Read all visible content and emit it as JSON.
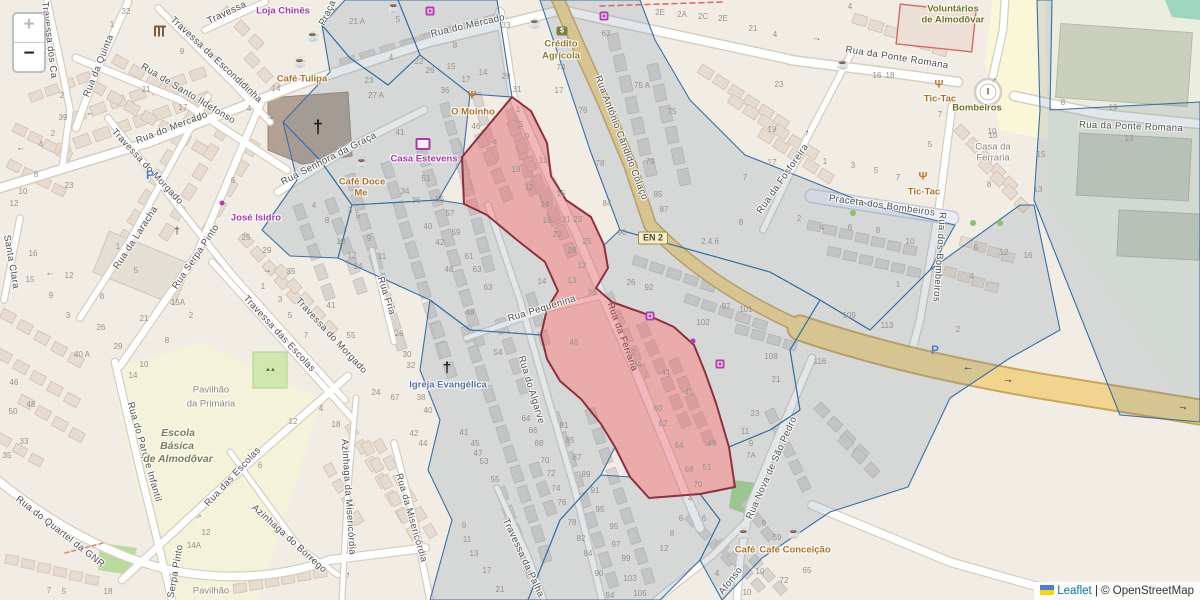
{
  "map": {
    "controls": {
      "zoom_in": "+",
      "zoom_out": "−"
    },
    "attribution": {
      "leaflet": "Leaflet",
      "separator": "|",
      "osm": "© OpenStreetMap"
    },
    "colors": {
      "background": "#f1ede5",
      "overlay_blue_stroke": "#3a70a3",
      "overlay_blue_fill": "rgba(110,134,158,0.20)",
      "overlay_red_fill": "rgba(222,84,90,0.42)",
      "overlay_red_stroke": "#8f3040",
      "highway_yellow": "#f1d48e"
    }
  },
  "badges": [
    [
      "EN 2",
      653,
      238
    ]
  ],
  "street_labels": [
    [
      "Rua do Mercado",
      172,
      128,
      -21
    ],
    [
      "Rua do Mercado",
      468,
      26,
      -13
    ],
    [
      "Travessa",
      227,
      13,
      -25
    ],
    [
      "Travessa dos Ca",
      49,
      40,
      83
    ],
    [
      "Travessa da Escondidinha",
      216,
      60,
      43
    ],
    [
      "Rua de Santo Ildefonso",
      188,
      94,
      31
    ],
    [
      "Rua da Quinta",
      99,
      66,
      -68
    ],
    [
      "Santa Clara",
      11,
      262,
      80
    ],
    [
      "Rua da Laracha",
      136,
      238,
      -57
    ],
    [
      "Rua Serpa Pinto",
      196,
      257,
      -56
    ],
    [
      "Rua Serpa Pinto",
      174,
      582,
      -80
    ],
    [
      "Travessa do Morgado",
      147,
      167,
      47
    ],
    [
      "Travessa do Morgado",
      331,
      336,
      47
    ],
    [
      "Travessa das Escolas",
      279,
      334,
      47
    ],
    [
      "Rua Fria",
      386,
      296,
      72
    ],
    [
      "Rua Senhora da Graça",
      329,
      159,
      -27
    ],
    [
      "Rua da Ponte Romana",
      897,
      58,
      9
    ],
    [
      "Rua da Ponte Romana",
      1131,
      127,
      2
    ],
    [
      "Rua da Fosforeira",
      783,
      179,
      -55
    ],
    [
      "Praceta dos Bombeiros",
      882,
      206,
      8
    ],
    [
      "Rua dos Bombeiros",
      939,
      257,
      94
    ],
    [
      "Rua António Cândido Colaço",
      621,
      138,
      69
    ],
    [
      "Rua da Ferraria",
      622,
      337,
      70,
      "on-red"
    ],
    [
      "Rua Pequenina",
      542,
      309,
      -17
    ],
    [
      "Rua do Algarve",
      531,
      390,
      73
    ],
    [
      "Rua da Misericórdia",
      411,
      518,
      74
    ],
    [
      "Travessa da Palha",
      523,
      558,
      65
    ],
    [
      "Rua das Escolas",
      233,
      477,
      -47
    ],
    [
      "Rua do Parque Infantil",
      144,
      452,
      74
    ],
    [
      "Rua do Quartel da GNR",
      60,
      532,
      38
    ],
    [
      "Azinhaga do Borrego",
      289,
      539,
      42
    ],
    [
      "Azinhaga da Misericórdia",
      348,
      497,
      86
    ],
    [
      "Rua Nova de São Pedro",
      772,
      468,
      -66
    ],
    [
      "Afonso",
      731,
      581,
      -52
    ],
    [
      "Praça",
      328,
      13,
      -64
    ]
  ],
  "poi_labels": [
    [
      "Loja Chinês",
      283,
      11,
      "shop"
    ],
    [
      "Café Tulipa",
      302,
      79,
      "food"
    ],
    [
      "Café Doce",
      362,
      182,
      "food"
    ],
    [
      "Me",
      361,
      193,
      "food"
    ],
    [
      "José Isidro",
      256,
      218,
      "shop"
    ],
    [
      "Casa Estevens",
      424,
      159,
      "shop"
    ],
    [
      "O Moinho",
      473,
      112,
      "food"
    ],
    [
      "Crédito",
      561,
      44,
      "bank"
    ],
    [
      "Agrícola",
      561,
      56,
      "bank"
    ],
    [
      "Voluntários",
      953,
      9,
      "civic"
    ],
    [
      "de Almodôvar",
      953,
      20,
      "civic"
    ],
    [
      "Bombeiros",
      977,
      108,
      "civic"
    ],
    [
      "Tic-Tac",
      940,
      99,
      "food"
    ],
    [
      "Tic-Tac",
      924,
      192,
      "food"
    ],
    [
      "Casa da",
      993,
      147,
      "grey"
    ],
    [
      "Ferraria",
      993,
      158,
      "grey"
    ],
    [
      "Igreja Evangélica",
      448,
      385,
      "church"
    ],
    [
      "Escola",
      178,
      433,
      "school"
    ],
    [
      "Básica",
      177,
      446,
      "school"
    ],
    [
      "de Almodôvar",
      178,
      459,
      "school"
    ],
    [
      "Pavilhão",
      211,
      390,
      "grey"
    ],
    [
      "da Primária",
      211,
      404,
      "grey"
    ],
    [
      "Pavilhão",
      211,
      591,
      "grey"
    ],
    [
      "Café",
      745,
      550,
      "food"
    ],
    [
      "Café Conceição",
      795,
      550,
      "food"
    ]
  ],
  "house_numbers": [
    [
      "32",
      126,
      12
    ],
    [
      "1",
      112,
      25
    ],
    [
      "9",
      182,
      52
    ],
    [
      "21",
      146,
      90
    ],
    [
      "17",
      183,
      108
    ],
    [
      "15",
      197,
      119
    ],
    [
      "4",
      249,
      109
    ],
    [
      "14",
      276,
      89
    ],
    [
      "2",
      62,
      96
    ],
    [
      "39",
      63,
      118
    ],
    [
      "2",
      53,
      134
    ],
    [
      "4",
      41,
      145
    ],
    [
      "8",
      36,
      175
    ],
    [
      "10",
      23,
      192
    ],
    [
      "23",
      69,
      186
    ],
    [
      "6",
      233,
      181
    ],
    [
      "12",
      14,
      204
    ],
    [
      "16",
      33,
      254
    ],
    [
      "15",
      30,
      280
    ],
    [
      "12",
      69,
      276
    ],
    [
      "9",
      51,
      296
    ],
    [
      "8",
      102,
      297
    ],
    [
      "3",
      68,
      316
    ],
    [
      "26",
      101,
      328
    ],
    [
      "5",
      136,
      271
    ],
    [
      "1",
      118,
      247
    ],
    [
      "29",
      118,
      347
    ],
    [
      "40 A",
      82,
      355
    ],
    [
      "46",
      14,
      383
    ],
    [
      "10",
      144,
      365
    ],
    [
      "14",
      133,
      376
    ],
    [
      "21",
      144,
      319
    ],
    [
      "15A",
      178,
      303
    ],
    [
      "2",
      191,
      316
    ],
    [
      "8",
      167,
      341
    ],
    [
      "25",
      246,
      238
    ],
    [
      "29",
      267,
      251
    ],
    [
      "35",
      291,
      272
    ],
    [
      "1",
      263,
      287
    ],
    [
      "3",
      280,
      300
    ],
    [
      "5",
      290,
      316
    ],
    [
      "7",
      306,
      336
    ],
    [
      "41",
      331,
      306
    ],
    [
      "55",
      351,
      336
    ],
    [
      "4",
      314,
      206
    ],
    [
      "3",
      350,
      211
    ],
    [
      "5",
      358,
      216
    ],
    [
      "8",
      327,
      221
    ],
    [
      "10",
      341,
      242
    ],
    [
      "9",
      369,
      239
    ],
    [
      "11",
      382,
      257
    ],
    [
      "14",
      358,
      267
    ],
    [
      "12",
      352,
      256
    ],
    [
      "24",
      376,
      393
    ],
    [
      "21 A",
      357,
      22
    ],
    [
      "5",
      398,
      20
    ],
    [
      "4",
      391,
      58
    ],
    [
      "8",
      455,
      46
    ],
    [
      "22",
      419,
      62
    ],
    [
      "26",
      430,
      71
    ],
    [
      "15",
      451,
      67
    ],
    [
      "23",
      369,
      81
    ],
    [
      "27 A",
      376,
      96
    ],
    [
      "36",
      445,
      91
    ],
    [
      "17",
      466,
      80
    ],
    [
      "14",
      483,
      73
    ],
    [
      "29",
      506,
      77
    ],
    [
      "31",
      517,
      90
    ],
    [
      "33",
      506,
      26
    ],
    [
      "17",
      559,
      91
    ],
    [
      "74",
      561,
      68
    ],
    [
      "46",
      476,
      127
    ],
    [
      "51",
      426,
      179
    ],
    [
      "41",
      400,
      133
    ],
    [
      "34",
      405,
      192
    ],
    [
      "36",
      416,
      201
    ],
    [
      "55",
      440,
      200
    ],
    [
      "57",
      450,
      214
    ],
    [
      "40",
      428,
      227
    ],
    [
      "59",
      456,
      233
    ],
    [
      "42",
      440,
      243
    ],
    [
      "61",
      469,
      257
    ],
    [
      "46",
      449,
      270
    ],
    [
      "63",
      477,
      270
    ],
    [
      "63",
      488,
      288
    ],
    [
      "48",
      470,
      313
    ],
    [
      "54",
      498,
      353
    ],
    [
      "1",
      518,
      110
    ],
    [
      "5",
      521,
      125
    ],
    [
      "9",
      527,
      137
    ],
    [
      "4",
      495,
      143
    ],
    [
      "19",
      516,
      170
    ],
    [
      "11",
      543,
      161
    ],
    [
      "12",
      529,
      188
    ],
    [
      "15",
      561,
      194
    ],
    [
      "14",
      545,
      205
    ],
    [
      "16",
      547,
      221
    ],
    [
      "21-23",
      572,
      220
    ],
    [
      "22",
      557,
      235
    ],
    [
      "25",
      587,
      242
    ],
    [
      "28",
      572,
      251
    ],
    [
      "12",
      582,
      266
    ],
    [
      "13",
      572,
      281
    ],
    [
      "36",
      592,
      293
    ],
    [
      "14",
      542,
      282
    ],
    [
      "63",
      606,
      34
    ],
    [
      "75 A",
      642,
      86
    ],
    [
      "75",
      672,
      112
    ],
    [
      "76",
      583,
      111
    ],
    [
      "78",
      600,
      164
    ],
    [
      "79",
      650,
      162
    ],
    [
      "85",
      658,
      195
    ],
    [
      "2E",
      660,
      13
    ],
    [
      "2A",
      682,
      15
    ],
    [
      "2C",
      703,
      17
    ],
    [
      "2E",
      723,
      19
    ],
    [
      "21",
      753,
      29
    ],
    [
      "4",
      775,
      35
    ],
    [
      "23",
      779,
      85
    ],
    [
      "19",
      772,
      130
    ],
    [
      "17",
      772,
      163
    ],
    [
      "7",
      745,
      178
    ],
    [
      "84",
      607,
      204
    ],
    [
      "87",
      664,
      210
    ],
    [
      "90",
      622,
      233
    ],
    [
      "2.4.6",
      710,
      242
    ],
    [
      "8",
      741,
      223
    ],
    [
      "26",
      631,
      283
    ],
    [
      "92",
      649,
      288
    ],
    [
      "97",
      726,
      307
    ],
    [
      "101",
      746,
      310
    ],
    [
      "102",
      703,
      323
    ],
    [
      "108",
      771,
      357
    ],
    [
      "21",
      776,
      380
    ],
    [
      "46",
      574,
      343
    ],
    [
      "52",
      631,
      353
    ],
    [
      "54",
      637,
      365
    ],
    [
      "41",
      666,
      373
    ],
    [
      "45",
      689,
      393
    ],
    [
      "4",
      850,
      7
    ],
    [
      "16",
      877,
      76
    ],
    [
      "18",
      890,
      76
    ],
    [
      "7",
      940,
      115
    ],
    [
      "10",
      992,
      132
    ],
    [
      "5",
      930,
      145
    ],
    [
      "1",
      825,
      162
    ],
    [
      "3",
      853,
      166
    ],
    [
      "5",
      876,
      171
    ],
    [
      "7",
      898,
      178
    ],
    [
      "8",
      989,
      185
    ],
    [
      "15",
      1041,
      155
    ],
    [
      "13",
      1038,
      190
    ],
    [
      "10",
      993,
      136
    ],
    [
      "2",
      799,
      219
    ],
    [
      "4",
      822,
      228
    ],
    [
      "6",
      850,
      228
    ],
    [
      "8",
      878,
      231
    ],
    [
      "10",
      910,
      242
    ],
    [
      "1",
      898,
      285
    ],
    [
      "109",
      849,
      316
    ],
    [
      "113",
      887,
      326
    ],
    [
      "116",
      820,
      362
    ],
    [
      "6",
      976,
      248
    ],
    [
      "12",
      1004,
      253
    ],
    [
      "16",
      1028,
      256
    ],
    [
      "4",
      972,
      277
    ],
    [
      "2",
      958,
      330
    ],
    [
      "8",
      1063,
      103
    ],
    [
      "19",
      1113,
      108
    ],
    [
      "13",
      1129,
      139
    ],
    [
      "50",
      13,
      412
    ],
    [
      "48",
      31,
      405
    ],
    [
      "33",
      24,
      442
    ],
    [
      "35",
      7,
      456
    ],
    [
      "12",
      293,
      422
    ],
    [
      "18",
      336,
      425
    ],
    [
      "4",
      321,
      409
    ],
    [
      "6",
      260,
      466
    ],
    [
      "12",
      206,
      533
    ],
    [
      "14A",
      194,
      546
    ],
    [
      "18",
      108,
      592
    ],
    [
      "7",
      49,
      591
    ],
    [
      "5",
      64,
      592
    ],
    [
      "40",
      428,
      411
    ],
    [
      "42",
      414,
      434
    ],
    [
      "44",
      423,
      444
    ],
    [
      "41",
      464,
      433
    ],
    [
      "45",
      475,
      444
    ],
    [
      "47",
      478,
      454
    ],
    [
      "53",
      484,
      462
    ],
    [
      "55",
      495,
      480
    ],
    [
      "64",
      526,
      419
    ],
    [
      "66",
      533,
      431
    ],
    [
      "68",
      539,
      444
    ],
    [
      "70",
      545,
      461
    ],
    [
      "72",
      551,
      474
    ],
    [
      "74",
      556,
      489
    ],
    [
      "76",
      562,
      503
    ],
    [
      "78",
      572,
      523
    ],
    [
      "81",
      564,
      426
    ],
    [
      "85",
      570,
      441
    ],
    [
      "87",
      577,
      458
    ],
    [
      "89",
      586,
      475
    ],
    [
      "91",
      595,
      491
    ],
    [
      "95",
      600,
      510
    ],
    [
      "95",
      614,
      527
    ],
    [
      "82",
      581,
      539
    ],
    [
      "84",
      588,
      554
    ],
    [
      "90",
      599,
      574
    ],
    [
      "94",
      610,
      596
    ],
    [
      "97",
      616,
      545
    ],
    [
      "99",
      626,
      559
    ],
    [
      "103",
      630,
      579
    ],
    [
      "105",
      640,
      594
    ],
    [
      "9",
      464,
      526
    ],
    [
      "11",
      467,
      540
    ],
    [
      "13",
      474,
      554
    ],
    [
      "17",
      487,
      571
    ],
    [
      "21",
      500,
      590
    ],
    [
      "26",
      399,
      334
    ],
    [
      "30",
      407,
      355
    ],
    [
      "32",
      411,
      366
    ],
    [
      "38",
      421,
      398
    ],
    [
      "67",
      395,
      398
    ],
    [
      "60",
      658,
      409
    ],
    [
      "62",
      663,
      424
    ],
    [
      "64",
      679,
      446
    ],
    [
      "49",
      712,
      444
    ],
    [
      "68",
      689,
      470
    ],
    [
      "51",
      707,
      468
    ],
    [
      "70",
      698,
      485
    ],
    [
      "4",
      690,
      499
    ],
    [
      "6",
      681,
      519
    ],
    [
      "6",
      704,
      519
    ],
    [
      "8",
      672,
      534
    ],
    [
      "12",
      664,
      549
    ],
    [
      "23",
      755,
      414
    ],
    [
      "11",
      745,
      432
    ],
    [
      "9",
      751,
      444
    ],
    [
      "7A",
      751,
      456
    ],
    [
      "9",
      764,
      524
    ],
    [
      "59",
      777,
      538
    ],
    [
      "10",
      760,
      572
    ],
    [
      "4",
      717,
      574
    ],
    [
      "10",
      747,
      593
    ],
    [
      "72",
      784,
      581
    ],
    [
      "65",
      807,
      571
    ]
  ],
  "icons": [
    {
      "n": "cafe-icon",
      "x": 394,
      "y": 8
    },
    {
      "n": "cafe-icon",
      "x": 535,
      "y": 24
    },
    {
      "n": "cafe-icon",
      "x": 313,
      "y": 37
    },
    {
      "n": "cafe-icon",
      "x": 300,
      "y": 63
    },
    {
      "n": "cafe-icon",
      "x": 362,
      "y": 163
    },
    {
      "n": "cafe-icon",
      "x": 843,
      "y": 65
    },
    {
      "n": "cafe-icon",
      "x": 744,
      "y": 534
    },
    {
      "n": "cafe-icon",
      "x": 794,
      "y": 534
    },
    {
      "n": "restaurant-icon",
      "x": 472,
      "y": 96
    },
    {
      "n": "restaurant-icon",
      "x": 939,
      "y": 85
    },
    {
      "n": "restaurant-icon",
      "x": 923,
      "y": 177
    },
    {
      "n": "bank-icon",
      "x": 562,
      "y": 31
    },
    {
      "n": "museum-icon",
      "x": 160,
      "y": 31
    },
    {
      "n": "tv-shop-icon",
      "x": 423,
      "y": 144
    },
    {
      "n": "shop-icon",
      "x": 430,
      "y": 11
    },
    {
      "n": "shop-icon",
      "x": 604,
      "y": 16
    },
    {
      "n": "shop-icon",
      "x": 650,
      "y": 316
    },
    {
      "n": "shop-icon",
      "x": 720,
      "y": 364
    },
    {
      "n": "poi-dot-icon",
      "x": 222,
      "y": 203
    },
    {
      "n": "poi-dot-icon",
      "x": 693,
      "y": 341
    },
    {
      "n": "church-cross-icon",
      "x": 318,
      "y": 127,
      "s": 18
    },
    {
      "n": "church-cross-icon",
      "x": 447,
      "y": 368,
      "s": 15
    },
    {
      "n": "chapel-icon",
      "x": 177,
      "y": 232
    },
    {
      "n": "fire-hydrant-icon",
      "x": 988,
      "y": 92
    },
    {
      "n": "parking-icon",
      "x": 150,
      "y": 175
    },
    {
      "n": "parking-icon",
      "x": 935,
      "y": 350
    },
    {
      "n": "tree-icon",
      "x": 973,
      "y": 223
    },
    {
      "n": "tree-icon",
      "x": 1000,
      "y": 223
    },
    {
      "n": "tree-icon",
      "x": 853,
      "y": 213
    },
    {
      "n": "playground-icon",
      "x": 270,
      "y": 370
    }
  ],
  "oneway_arrows": [
    [
      90,
      115,
      180
    ],
    [
      21,
      150,
      180
    ],
    [
      270,
      117,
      0
    ],
    [
      50,
      275,
      180
    ],
    [
      267,
      270,
      0
    ],
    [
      336,
      10,
      115
    ],
    [
      993,
      80,
      -60
    ],
    [
      806,
      133,
      -75
    ],
    [
      198,
      516,
      -40
    ],
    [
      347,
      575,
      -85
    ],
    [
      312,
      558,
      40
    ],
    [
      817,
      38,
      10
    ]
  ],
  "highway_arrows": [
    [
      968,
      369,
      180
    ],
    [
      1008,
      380,
      8
    ],
    [
      1183,
      407,
      10
    ]
  ]
}
